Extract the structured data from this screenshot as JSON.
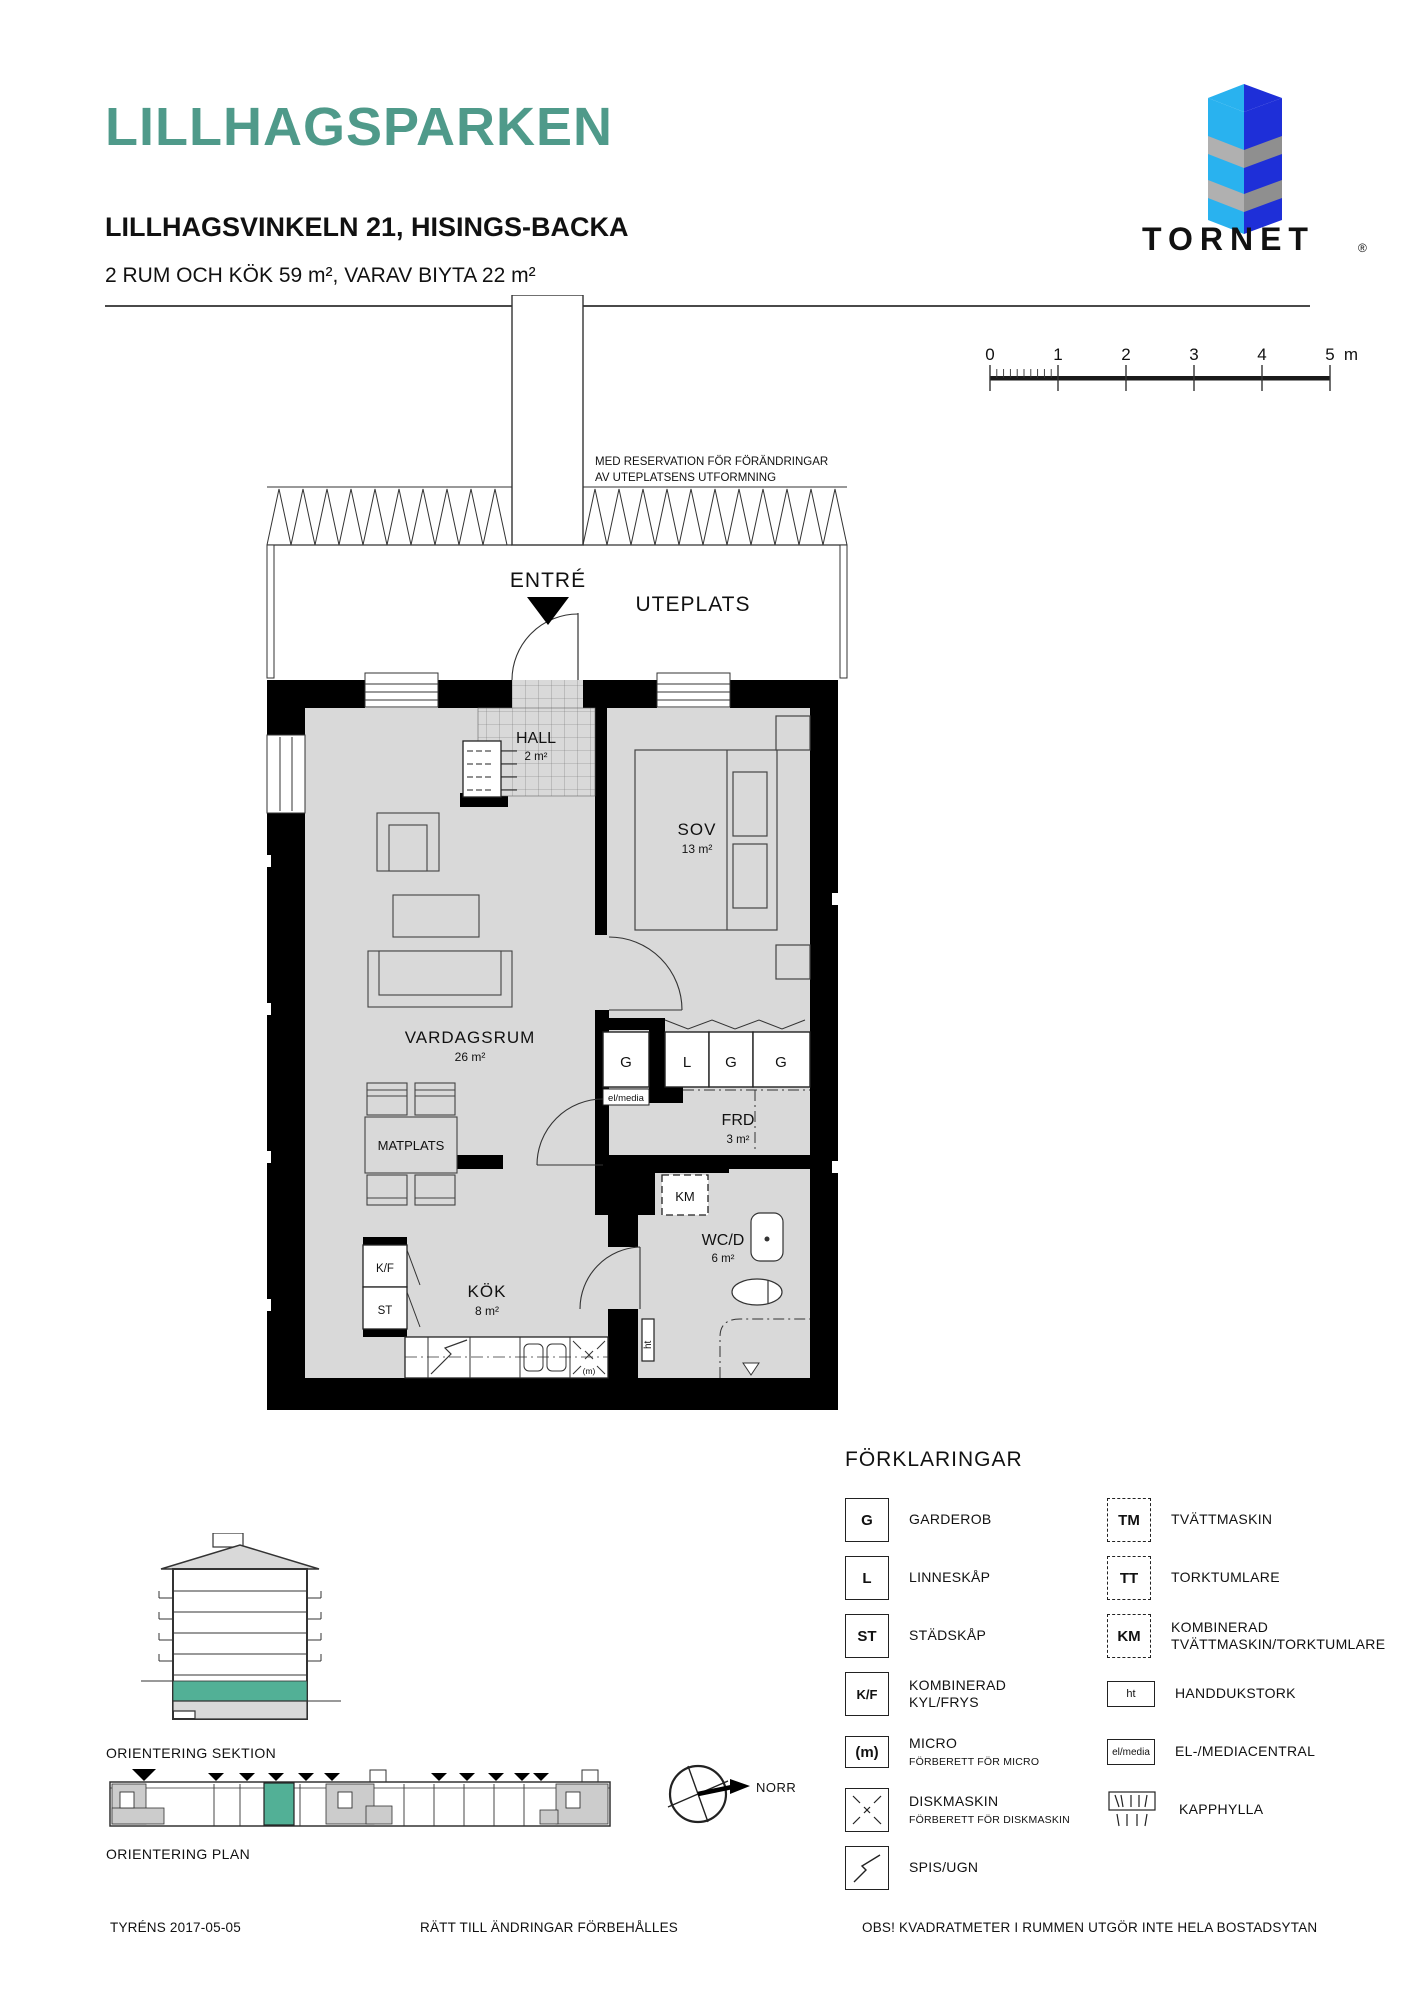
{
  "header": {
    "title": "LILLHAGSPARKEN",
    "subtitle": "LILLHAGSVINKELN 21, HISINGS-BACKA",
    "summary": "2 RUM OCH KÖK 59 m², VARAV BIYTA 22 m²"
  },
  "logo": {
    "brand": "TORNET",
    "reg": "®"
  },
  "colors": {
    "accent": "#4f9a8a",
    "floor_gray": "#d9d9d9",
    "highlight_teal": "#52b096",
    "logo_light_blue": "#29b2ef",
    "logo_dark_blue": "#1e2fd8",
    "logo_gray": "#9a9a9a",
    "logo_text_gray": "#4a4a4a"
  },
  "scale_bar": {
    "ticks": [
      "0",
      "1",
      "2",
      "3",
      "4",
      "5"
    ],
    "unit": "m"
  },
  "plan": {
    "note_line1": "MED RESERVATION FÖR FÖRÄNDRINGAR",
    "note_line2": "AV UTEPLATSENS UTFORMNING",
    "entre_label": "ENTRÉ",
    "uteplats_label": "UTEPLATS",
    "rooms": {
      "hall": {
        "name": "HALL",
        "area": "2 m²"
      },
      "sov": {
        "name": "SOV",
        "area": "13 m²"
      },
      "vardagsrum": {
        "name": "VARDAGSRUM",
        "area": "26 m²"
      },
      "matplats": {
        "name": "MATPLATS"
      },
      "frd": {
        "name": "FRD",
        "area": "3 m²"
      },
      "kok": {
        "name": "KÖK",
        "area": "8 m²"
      },
      "wcd": {
        "name": "WC/D",
        "area": "6 m²"
      }
    },
    "fixtures": {
      "garderob1": "G",
      "linneskap": "L",
      "garderob2": "G",
      "garderob3": "G",
      "km": "KM",
      "elmedia": "el/media",
      "ht": "ht",
      "kf": "K/F",
      "st": "ST",
      "micro": "(m)"
    }
  },
  "legend": {
    "title": "FÖRKLARINGAR",
    "left": [
      {
        "symbol": "G",
        "label": "GARDEROB"
      },
      {
        "symbol": "L",
        "label": "LINNESKÅP"
      },
      {
        "symbol": "ST",
        "label": "STÄDSKÅP"
      },
      {
        "symbol": "K/F",
        "label": "KOMBINERAD",
        "label2": "KYL/FRYS"
      },
      {
        "symbol": "(m)",
        "label": "MICRO",
        "sub": "FÖRBERETT FÖR MICRO"
      },
      {
        "symbol": "diskmaskin-icon",
        "label": "DISKMASKIN",
        "sub": "FÖRBERETT FÖR DISKMASKIN"
      },
      {
        "symbol": "spis-icon",
        "label": "SPIS/UGN"
      }
    ],
    "right": [
      {
        "symbol": "TM",
        "label": "TVÄTTMASKIN"
      },
      {
        "symbol": "TT",
        "label": "TORKTUMLARE"
      },
      {
        "symbol": "KM",
        "label": "KOMBINERAD",
        "label2": "TVÄTTMASKIN/TORKTUMLARE"
      },
      {
        "symbol": "ht",
        "label": "HANDDUKSTORK"
      },
      {
        "symbol": "el/media",
        "label": "EL-/MEDIACENTRAL"
      },
      {
        "symbol": "kapphylla-icon",
        "label": "KAPPHYLLA"
      }
    ]
  },
  "orientation": {
    "sektion_label": "ORIENTERING SEKTION",
    "plan_label": "ORIENTERING PLAN",
    "north_label": "NORR"
  },
  "footer": {
    "left": "TYRÉNS 2017-05-05",
    "center": "RÄTT TILL ÄNDRINGAR FÖRBEHÅLLES",
    "right": "OBS! KVADRATMETER I RUMMEN UTGÖR INTE HELA BOSTADSYTAN"
  }
}
